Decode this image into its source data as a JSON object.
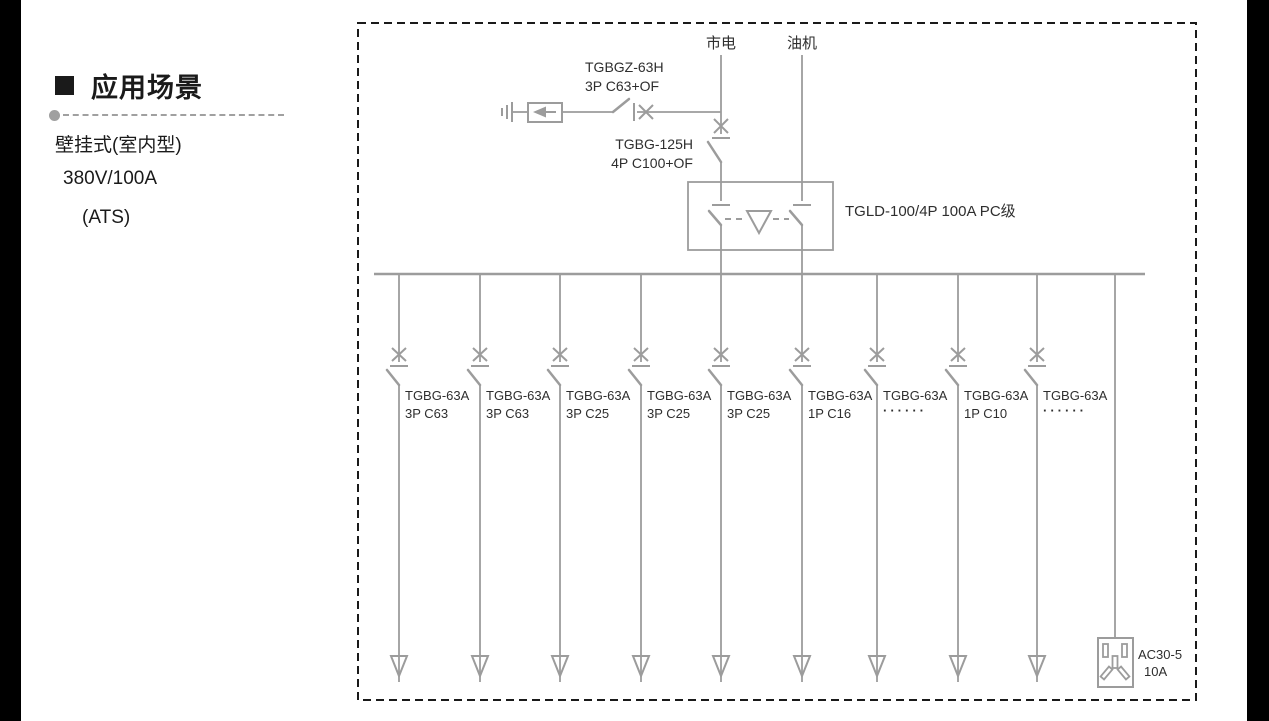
{
  "left_panel": {
    "heading": "应用场景",
    "line1": "壁挂式(室内型)",
    "line2": "380V/100A",
    "line3": "(ATS)"
  },
  "diagram": {
    "colors": {
      "line": "#9c9c9c",
      "text": "#2e2e2e",
      "border": "#1a1a1a",
      "sidebar": "#000000"
    },
    "icons": [
      "ground-icon",
      "surge-arrester-icon",
      "breaker-icon",
      "ats-interlock-icon",
      "load-arrow-icon",
      "socket-icon"
    ],
    "source_mains": "市电",
    "source_generator": "油机",
    "spd_breaker": {
      "model": "TGBGZ-63H",
      "spec": "3P C63+OF"
    },
    "main_breaker": {
      "model": "TGBG-125H",
      "spec": "4P C100+OF"
    },
    "ats": {
      "label": "TGLD-100/4P 100A PC级"
    },
    "branches": [
      {
        "model": "TGBG-63A",
        "spec": "3P C63"
      },
      {
        "model": "TGBG-63A",
        "spec": "3P C63"
      },
      {
        "model": "TGBG-63A",
        "spec": "3P C25"
      },
      {
        "model": "TGBG-63A",
        "spec": "3P C25"
      },
      {
        "model": "TGBG-63A",
        "spec": "3P C25"
      },
      {
        "model": "TGBG-63A",
        "spec": "1P C16"
      },
      {
        "model": "TGBG-63A",
        "spec": "······"
      },
      {
        "model": "TGBG-63A",
        "spec": "1P C10"
      },
      {
        "model": "TGBG-63A",
        "spec": "······"
      }
    ],
    "socket": {
      "model": "AC30-5",
      "rating": "10A"
    }
  }
}
